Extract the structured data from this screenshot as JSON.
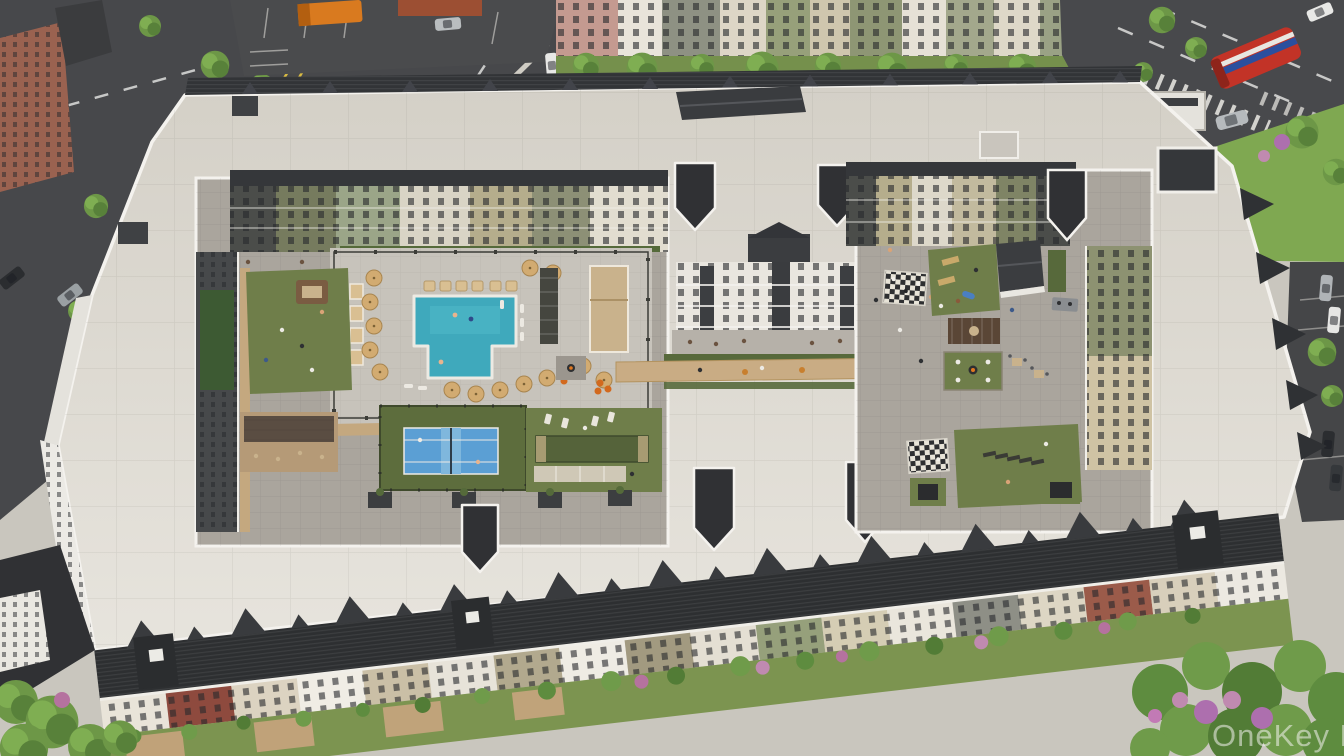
{
  "image": {
    "type": "aerial-architectural-rendering",
    "subject": "Bird's-eye 3D rendering of a full-block apartment community with interior courtyard amenity decks",
    "watermark": "OneKey MLS"
  },
  "scene": {
    "amenities": [
      "swimming-pool",
      "pool-deck-with-umbrellas",
      "cabanas",
      "shade-sail-bar-seating",
      "pool-pavilion",
      "pergola-lounges",
      "orange-lounge-chairs",
      "fire-pit-lounges",
      "pickleball-court",
      "bocce-court",
      "shuffleboard",
      "cornhole-lawn",
      "grill-lawn",
      "dining-terrace",
      "giant-chess-board-north",
      "giant-chess-board-south",
      "dog-park",
      "dog-park-shed",
      "lounge-lawn-with-sunbeds",
      "planter-fire-features",
      "central-promenade",
      "balcony-facades"
    ],
    "streets": [
      "intersection-with-zebra-crosswalk",
      "yellow-turn-lane-markings",
      "avenue-with-hatched-crosswalks",
      "surface-parking-lots",
      "gas-station-price-sign",
      "street-trees",
      "sidewalks"
    ],
    "vehicles": [
      "red-transit-bus-with-blue-white-stripe",
      "orange-box-truck",
      "silver-minivan",
      "dark-sedans",
      "silver-sedans",
      "white-sedans",
      "red-hatchback"
    ],
    "buildings": [
      "perimeter-apartment-block-flat-white-roof",
      "dark-shingle-mansard-edges",
      "gabled-street-facades",
      "stair-tower-caps",
      "background-townhouse-row",
      "corner-brick-building",
      "rooftop-penthouse-hall",
      "bus-shelter"
    ],
    "palette": {
      "asphalt": "#47484b",
      "flat_roof": "#dcd8cf",
      "parapet_white": "#f4f2ee",
      "dark_shingle": "#2e3033",
      "courtyard_pavers": "#aaa59d",
      "pool_water": "#3fa9bc",
      "court_blue": "#5b9fd4",
      "turf_green": "#6f7e4a",
      "street_lawn": "#7fa851",
      "walkway_tan": "#c9ac84",
      "umbrella_tan": "#d2ab71",
      "bus_red": "#c23327",
      "bus_stripe_blue": "#2b4f9e",
      "accent_orange": "#d2691e",
      "flowering_purple": "#ad6fae",
      "lane_yellow": "#d9bb43"
    }
  }
}
